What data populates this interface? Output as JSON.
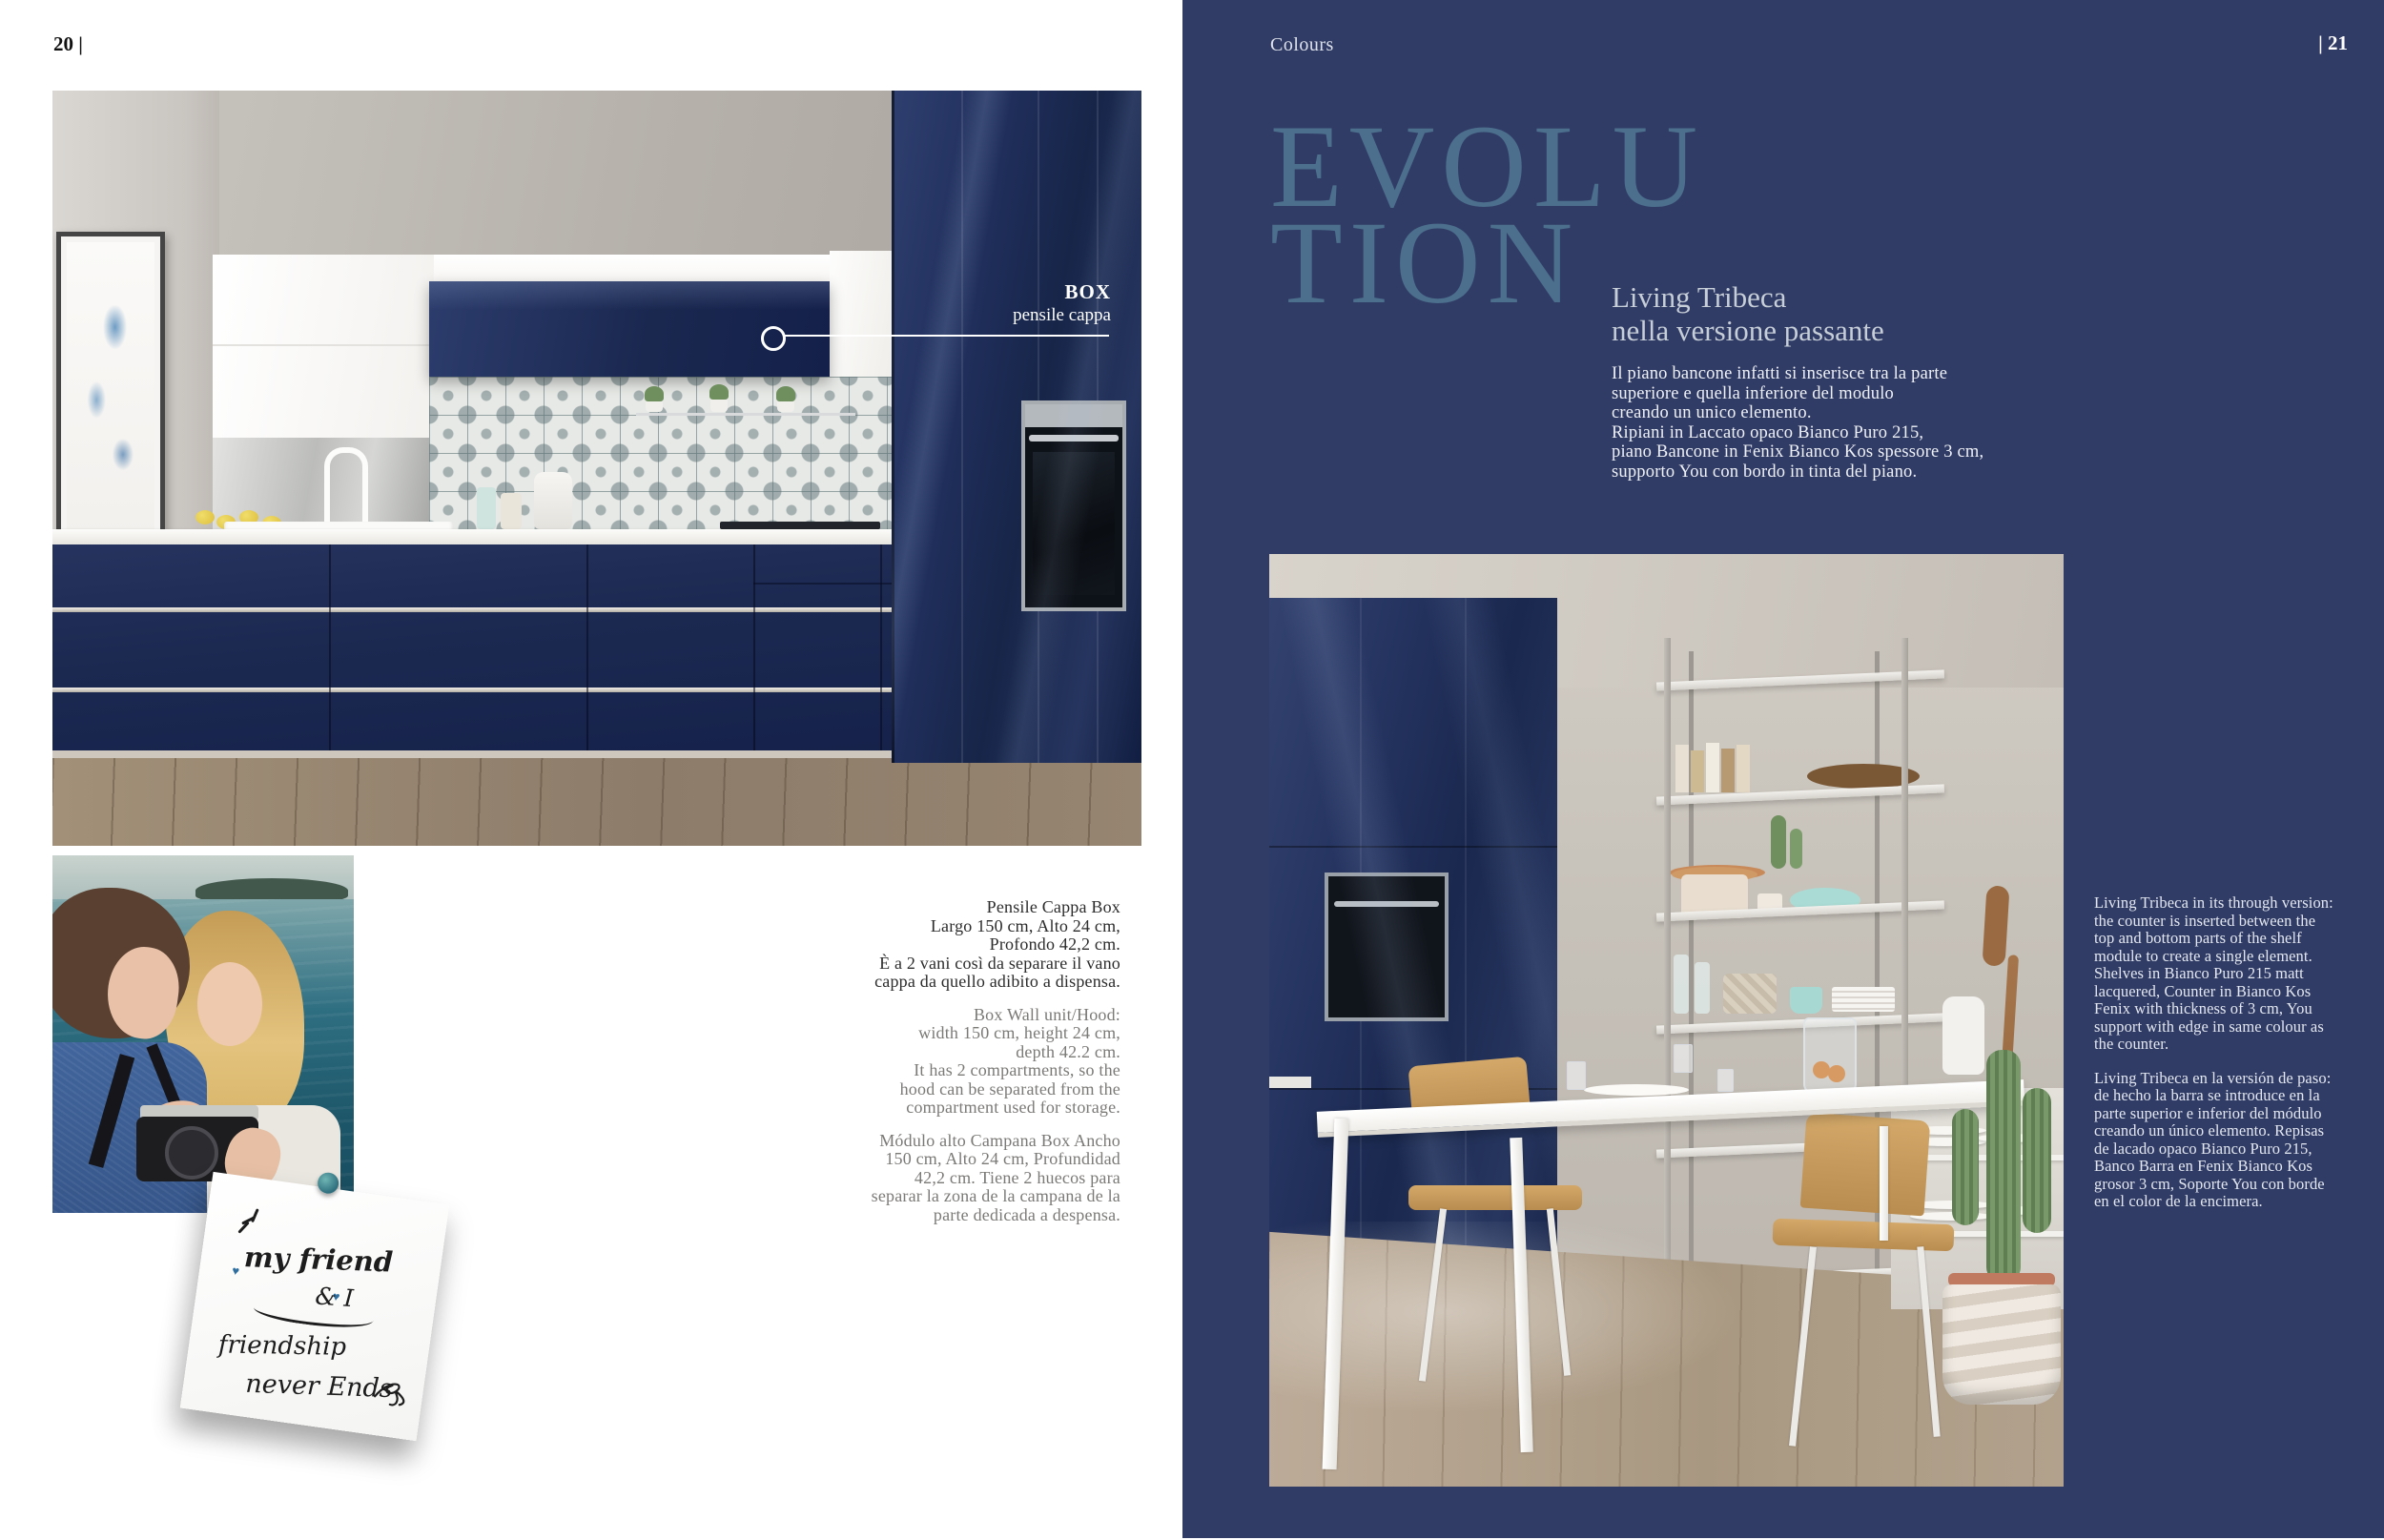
{
  "left_page": {
    "page_number": "20 |",
    "callout": {
      "title": "BOX",
      "subtitle": "pensile cappa"
    },
    "specs": {
      "it": [
        "Pensile Cappa Box",
        "Largo 150 cm, Alto 24 cm,",
        "Profondo 42,2 cm.",
        "È a 2 vani così da separare il vano",
        "cappa da quello adibito a dispensa."
      ],
      "en": [
        "Box Wall unit/Hood:",
        "width 150 cm, height 24 cm,",
        "depth 42.2 cm.",
        "It has 2 compartments, so the",
        "hood can be separated from the",
        "compartment used for storage."
      ],
      "es": [
        "Módulo alto Campana Box Ancho",
        "150 cm, Alto 24 cm, Profundidad",
        "42,2 cm. Tiene 2 huecos para",
        "separar la zona de la campana de la",
        "parte dedicada a despensa."
      ]
    },
    "note": {
      "line1": "my friend",
      "line2": "& I",
      "line3": "friendship",
      "line4": "never Ends"
    }
  },
  "right_page": {
    "header": "Colours",
    "page_number": "| 21",
    "display_title": {
      "line1": "EVOLU",
      "line2": "TION"
    },
    "heading": {
      "line1": "Living Tribeca",
      "line2": "nella versione passante"
    },
    "intro_it": [
      "Il piano bancone infatti si inserisce tra la parte",
      "superiore e quella inferiore del modulo",
      "creando un unico elemento.",
      "Ripiani in Laccato opaco Bianco Puro 215,",
      "piano Bancone in Fenix Bianco Kos spessore 3 cm,",
      "supporto You con bordo in tinta del piano."
    ],
    "description_en": "Living Tribeca in its through version: the counter is inserted between the top and bottom parts of the shelf module to create a single element. Shelves in Bianco Puro 215 matt lacquered, Counter in Bianco Kos Fenix with thickness of 3 cm, You support with edge in same colour as the counter.",
    "description_es": "Living Tribeca en la versión de paso: de hecho la barra se introduce en la parte superior e inferior del módulo creando un único elemento. Repisas de lacado opaco Bianco Puro 215, Banco Barra en Fenix Bianco Kos grosor 3 cm, Soporte You con borde en el color de la encimera."
  },
  "colors": {
    "page_navy": "#313c66",
    "display_title_blue": "#4b6f8d",
    "heading_gray_blue": "#c6ced8",
    "body_light": "#eef1f6",
    "cabinet_navy": "#1b2951",
    "pin_teal": "#3b7f8a",
    "spec_text_dark": "#2c2c2c",
    "spec_text_gray": "#7b7a77"
  }
}
